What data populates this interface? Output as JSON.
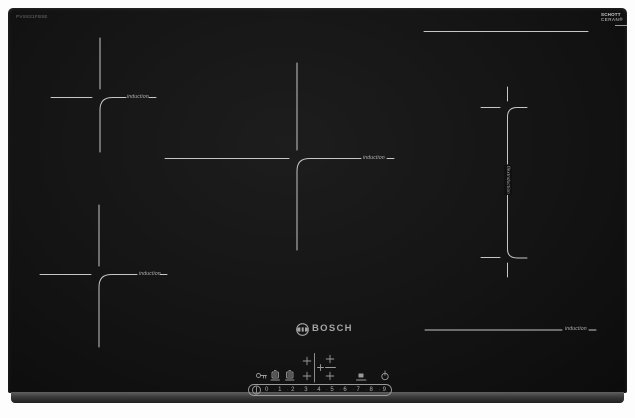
{
  "image_type": "product photo of induction cooktop",
  "model_code": "PVS831FB5E",
  "brand": {
    "logo_text": "BOSCH"
  },
  "glass_brand": {
    "line1": "SCHOTT",
    "line2": "CERAN®"
  },
  "zones": {
    "rear_left": {
      "label": "induction"
    },
    "front_left": {
      "label": "induction"
    },
    "center": {
      "label": "induction"
    },
    "front_right": {
      "label": "induction"
    },
    "flex_right": {
      "label": "flexInduction"
    }
  },
  "control_panel": {
    "icon_names": [
      "key-lock-icon",
      "timer-icon",
      "stopwatch-icon",
      "zone-select-map",
      "pot-timer-icon",
      "power-icon",
      "level-indicator-icon"
    ],
    "power_levels": [
      "0",
      "1",
      "2",
      "3",
      "4",
      "5",
      "6",
      "7",
      "8",
      "9"
    ]
  },
  "colors": {
    "zone_line": "#c6c6c6",
    "label_text": "#b5b5b5",
    "logo": "#a5a5a5",
    "panel_line": "#9a9a9a",
    "surface": "#141414"
  }
}
